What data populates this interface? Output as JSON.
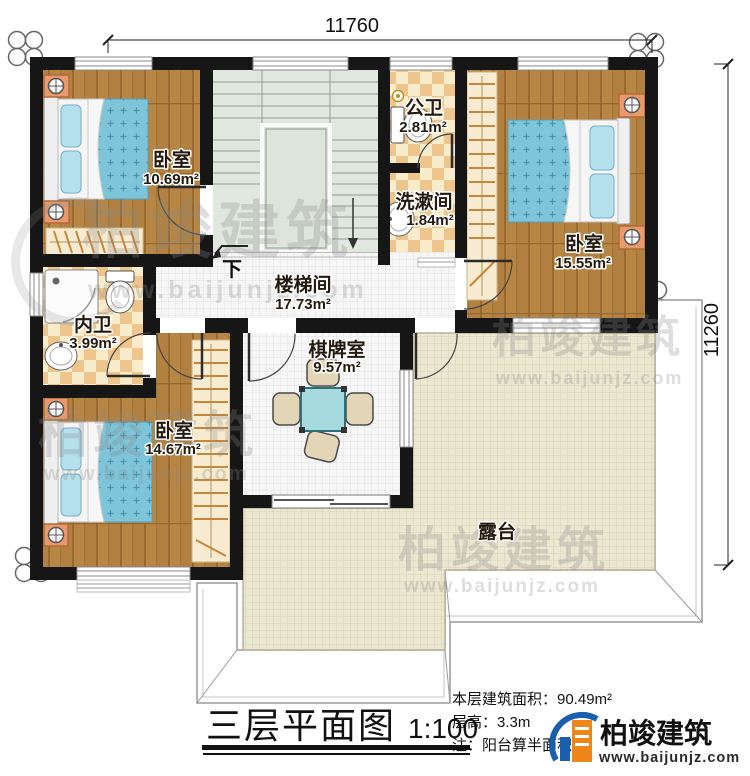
{
  "dimensions": {
    "top": "11760",
    "right": "11260"
  },
  "rooms": {
    "bedroom_top_left": {
      "label": "卧室",
      "area": "10.69m²"
    },
    "public_bathroom": {
      "label": "公卫",
      "area": "2.81m²"
    },
    "washroom": {
      "label": "洗漱间",
      "area": "1.84m²"
    },
    "bedroom_right": {
      "label": "卧室",
      "area": "15.55m²"
    },
    "stairwell": {
      "label": "楼梯间",
      "area": "17.73m²"
    },
    "inner_bathroom": {
      "label": "内卫",
      "area": "3.99m²"
    },
    "bedroom_bottom_left": {
      "label": "卧室",
      "area": "14.67m²"
    },
    "chess_room": {
      "label": "棋牌室",
      "area": "9.57m²"
    },
    "terrace": {
      "label": "露台"
    }
  },
  "stairs": {
    "direction_label": "下"
  },
  "title_block": {
    "title": "三层平面图",
    "scale": "1:100"
  },
  "info": {
    "floor_area": "本层建筑面积：90.49m²",
    "floor_height": "层高：3.3m",
    "note": "注：阳台算半面积"
  },
  "brand": {
    "name": "柏竣建筑",
    "website": "www.baijunjz.com"
  },
  "watermark": {
    "name": "柏竣建筑",
    "website": "www.baijunjz.com"
  },
  "colors": {
    "wall": "#161616",
    "wood_floor": "#b28141",
    "tile_floor": "#f6f6f6",
    "terrace_floor": "#ebe7d1",
    "bath_tile_dark": "#eec58c",
    "bath_tile_light": "#f9ecca",
    "stair_floor": "#e0e7de",
    "bed_blue": "#7ec5da",
    "furniture_orange": "#e89a6c",
    "table_teal": "#a6dade",
    "logo_blue": "#1a5fae",
    "logo_orange": "#f08519"
  }
}
